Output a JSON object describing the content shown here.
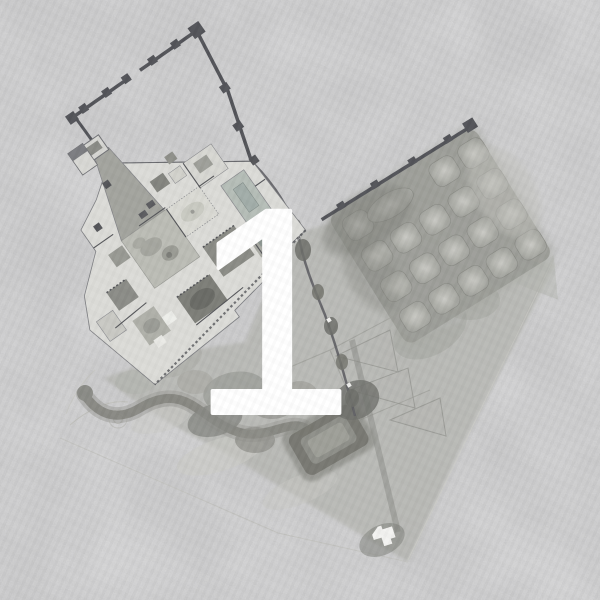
{
  "figure": {
    "label": "1"
  },
  "colors": {
    "paper": "#e4e4e5",
    "wall_ink": "#54555a",
    "numeral": "#ffffff",
    "building_fill": "#dcdcd8",
    "garden_wash": "#b5b6b1",
    "orchard_fill": "#9b9c97",
    "pool_dark": "#75766f"
  }
}
